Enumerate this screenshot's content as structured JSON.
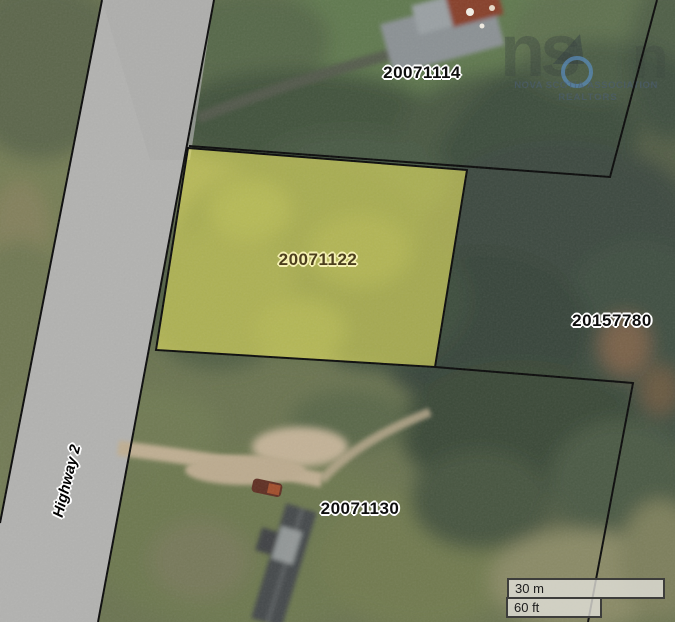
{
  "map": {
    "parcels": [
      {
        "label": "20071114",
        "highlighted": false
      },
      {
        "label": "20071122",
        "highlighted": true
      },
      {
        "label": "20157780",
        "highlighted": false
      },
      {
        "label": "20071130",
        "highlighted": false
      }
    ],
    "road": {
      "label": "Highway 2"
    },
    "scalebar": {
      "metric": "30 m",
      "imperial": "60 ft"
    },
    "watermark": {
      "logo_left": "ns",
      "logo_right": "n",
      "org_line1": "NOVA SCOTIA ASSOCIATION",
      "org_line2": "REALTORS"
    },
    "colors": {
      "highlight_fill": "#d9d655",
      "boundary": "#0a0a0a",
      "road_fill": "#b2b2b0",
      "logo_blue": "#5488b8"
    }
  }
}
